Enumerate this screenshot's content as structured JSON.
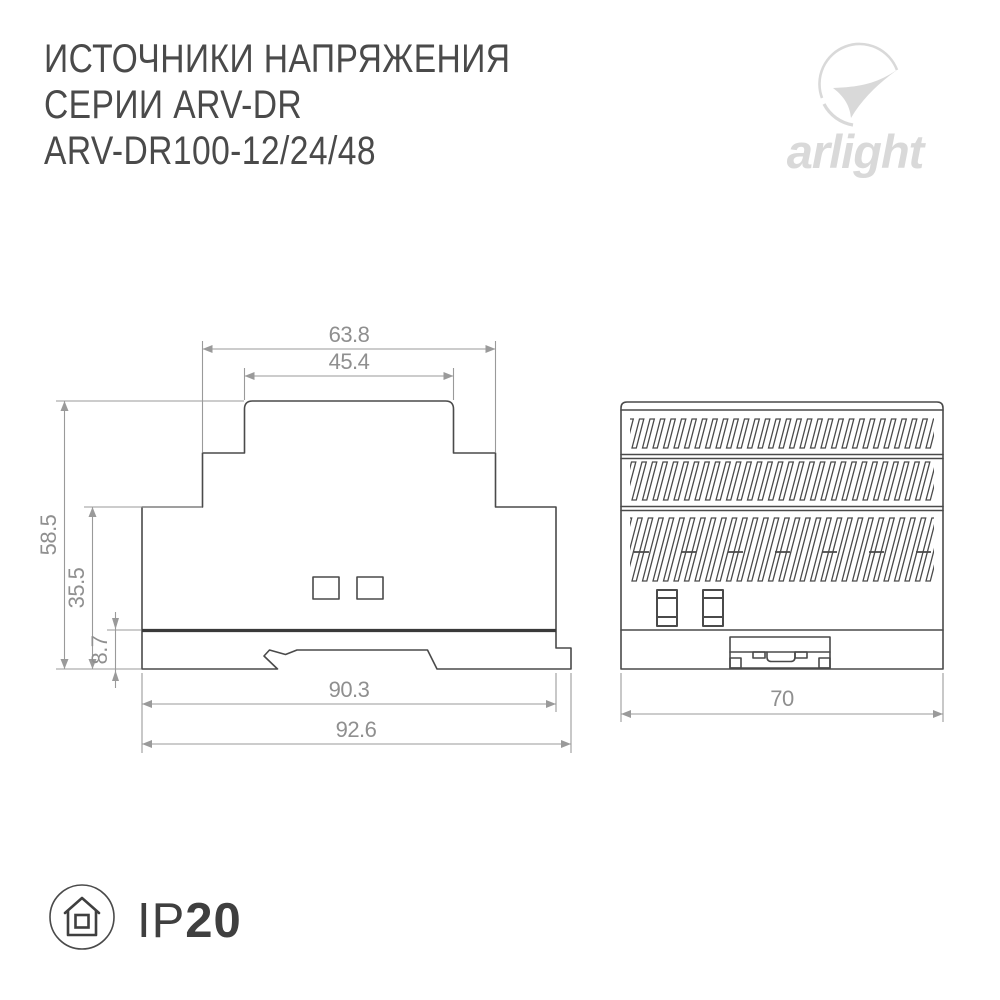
{
  "header": {
    "title_lines": [
      "ИСТОЧНИКИ НАПРЯЖЕНИЯ",
      "СЕРИИ ARV-DR",
      "ARV-DR100-12/24/48"
    ],
    "logo": {
      "brand": "arlight",
      "icon": "arlight-swoosh-icon",
      "color": "#d9d9d9"
    }
  },
  "drawing": {
    "side_view": {
      "description": "side profile with DIN-rail mount",
      "dimensions": {
        "top_inner_width": "45.4",
        "top_outer_width": "63.8",
        "total_height": "58.5",
        "body_height": "35.5",
        "rail_section_height": "8.7",
        "body_width": "90.3",
        "total_width": "92.6"
      }
    },
    "front_view": {
      "description": "front face with vent grilles and DIN clip",
      "dimensions": {
        "width": "70"
      }
    },
    "colors": {
      "outline": "#4a4a4a",
      "dimension": "#9a9a9a"
    }
  },
  "footer": {
    "ip_rating": {
      "icon": "house-in-circle-icon",
      "prefix": "IP",
      "value": "20"
    }
  }
}
